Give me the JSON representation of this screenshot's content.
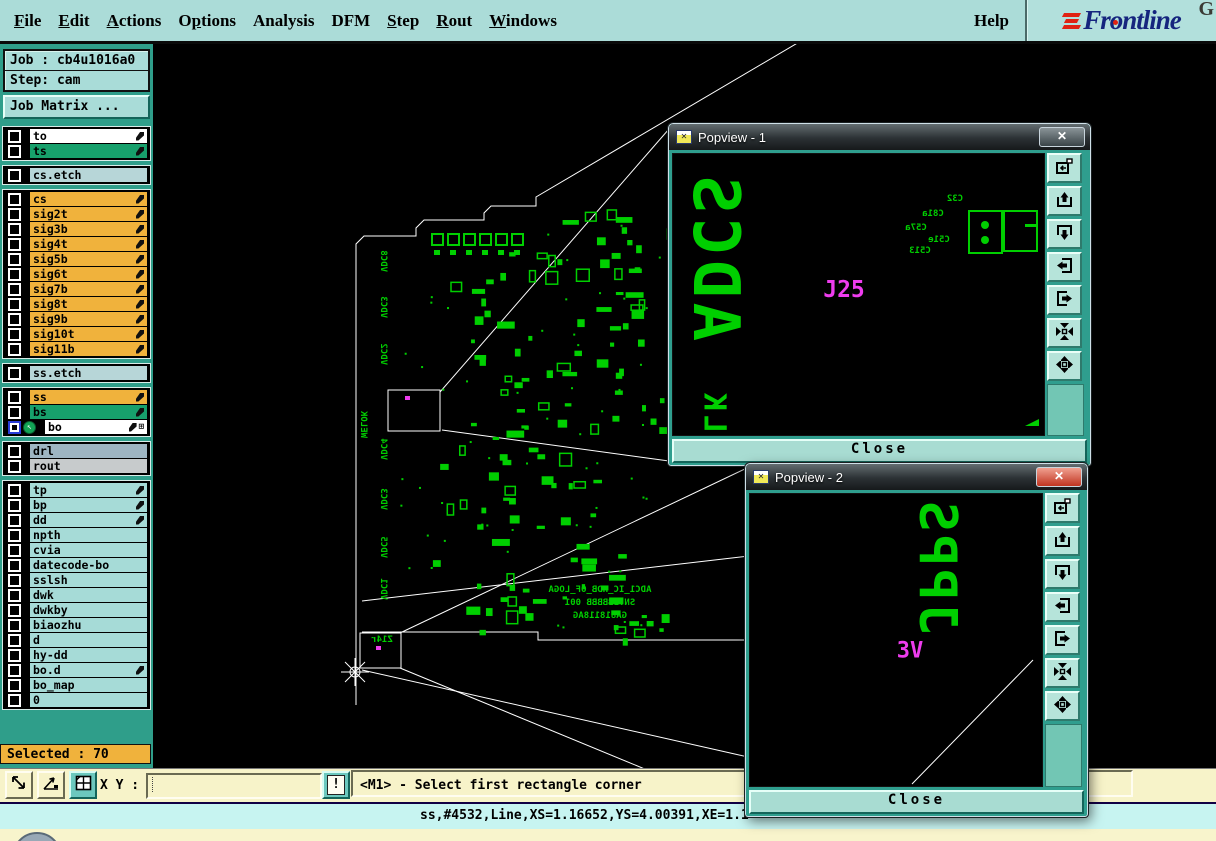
{
  "menubar": {
    "items": [
      {
        "label": "File",
        "u": 0
      },
      {
        "label": "Edit",
        "u": 0
      },
      {
        "label": "Actions",
        "u": 0
      },
      {
        "label": "Options",
        "u": 1
      },
      {
        "label": "Analysis",
        "u": -1
      },
      {
        "label": "DFM",
        "u": -1
      },
      {
        "label": "Step",
        "u": 0
      },
      {
        "label": "Rout",
        "u": 0
      },
      {
        "label": "Windows",
        "u": 0
      }
    ],
    "help": {
      "label": "Help",
      "u": -1
    },
    "logo": {
      "text": "Frontline",
      "corner_letter": "G",
      "navy": "#15257e",
      "red": "#e02212"
    }
  },
  "sidebar": {
    "job_label": "Job : cb4u1016a0",
    "step_label": "Step: cam",
    "job_matrix_button": "Job Matrix ...",
    "selected_label": "Selected : 70",
    "layer_groups": [
      {
        "rows": [
          {
            "label": "to",
            "color": "white",
            "feather": true
          },
          {
            "label": "ts",
            "color": "green",
            "feather": true
          }
        ]
      },
      {
        "rows": [
          {
            "label": "cs.etch",
            "color": "pale"
          }
        ]
      },
      {
        "rows": [
          {
            "label": "cs",
            "color": "orange",
            "feather": true
          },
          {
            "label": "sig2t",
            "color": "orange",
            "feather": true
          },
          {
            "label": "sig3b",
            "color": "orange",
            "feather": true
          },
          {
            "label": "sig4t",
            "color": "orange",
            "feather": true
          },
          {
            "label": "sig5b",
            "color": "orange",
            "feather": true
          },
          {
            "label": "sig6t",
            "color": "orange",
            "feather": true
          },
          {
            "label": "sig7b",
            "color": "orange",
            "feather": true
          },
          {
            "label": "sig8t",
            "color": "orange",
            "feather": true
          },
          {
            "label": "sig9b",
            "color": "orange",
            "feather": true
          },
          {
            "label": "sig10t",
            "color": "orange",
            "feather": true
          },
          {
            "label": "sig11b",
            "color": "orange",
            "feather": true
          }
        ]
      },
      {
        "rows": [
          {
            "label": "ss.etch",
            "color": "pale"
          }
        ]
      },
      {
        "rows": [
          {
            "label": "ss",
            "color": "orange",
            "feather": true
          },
          {
            "label": "bs",
            "color": "green",
            "feather": true
          },
          {
            "label": "bo",
            "color": "white",
            "feather": true,
            "active": true,
            "grid": true
          }
        ]
      },
      {
        "rows": [
          {
            "label": "drl",
            "color": "slate"
          },
          {
            "label": "rout",
            "color": "gray"
          }
        ]
      },
      {
        "rows": [
          {
            "label": "tp",
            "color": "cyan",
            "feather": true
          },
          {
            "label": "bp",
            "color": "cyan",
            "feather": true
          },
          {
            "label": "dd",
            "color": "cyan",
            "feather": true
          },
          {
            "label": "npth",
            "color": "cyan"
          },
          {
            "label": "cvia",
            "color": "cyan"
          },
          {
            "label": "datecode-bo",
            "color": "cyan"
          },
          {
            "label": "sslsh",
            "color": "cyan"
          },
          {
            "label": "dwk",
            "color": "cyan"
          },
          {
            "label": "dwkby",
            "color": "cyan"
          },
          {
            "label": "biaozhu",
            "color": "cyan"
          },
          {
            "label": "d",
            "color": "cyan"
          },
          {
            "label": "hy-dd",
            "color": "cyan"
          },
          {
            "label": "bo.d",
            "color": "cyan",
            "feather": true
          },
          {
            "label": "bo_map",
            "color": "cyan"
          },
          {
            "label": "0",
            "color": "cyan"
          }
        ]
      }
    ]
  },
  "bottom_toolbar": {
    "xy_label": "X Y :",
    "xy_value": "",
    "alert_label": "!",
    "icons": [
      {
        "name": "resize-diagonal-icon"
      },
      {
        "name": "angle-snap-icon"
      },
      {
        "name": "tile-grid-icon"
      }
    ]
  },
  "prompt_bar": {
    "text": "<M1> - Select first rectangle corner"
  },
  "status_bar": {
    "text": "ss,#4532,Line,XS=1.16652,YS=4.00391,XE=1.1"
  },
  "canvas": {
    "left_labels": [
      "VDC8",
      "VDC3",
      "VDC2",
      "VDC4",
      "VDC3",
      "VDC5",
      "VDC1"
    ],
    "left_label_bottom": "WELOK",
    "board_text_lines": [
      "ADC1_IC_HDB_OF_LOGA",
      "SN:BBBBBB 001",
      "GA818118AG"
    ],
    "zoom_rect_label": "Z14r"
  },
  "popviews": [
    {
      "title": "Popview - 1",
      "close_x": "✕",
      "close_label": "Close",
      "big_vertical": "ADCS",
      "ref_label": "J25",
      "corner_label": "LK",
      "small_refs": [
        "C32",
        "C81a",
        "C57a",
        "C51e",
        "C513"
      ],
      "tool_icons": [
        {
          "name": "view-snapshot-icon"
        },
        {
          "name": "pan-up-icon"
        },
        {
          "name": "pan-down-icon"
        },
        {
          "name": "pan-left-icon"
        },
        {
          "name": "pan-right-icon"
        },
        {
          "name": "zoom-out-icon"
        },
        {
          "name": "zoom-in-icon"
        }
      ]
    },
    {
      "title": "Popview - 2",
      "close_x": "✕",
      "close_label": "Close",
      "big_vertical": "JPPS",
      "ref_label": "3V",
      "small_refs": [],
      "tool_icons": [
        {
          "name": "view-snapshot-icon"
        },
        {
          "name": "pan-up-icon"
        },
        {
          "name": "pan-down-icon"
        },
        {
          "name": "pan-left-icon"
        },
        {
          "name": "pan-right-icon"
        },
        {
          "name": "zoom-out-icon"
        },
        {
          "name": "zoom-in-icon"
        }
      ]
    }
  ],
  "colors": {
    "menu_bg": "#abdcd8",
    "sidebar_teal": "#2f9e8a",
    "layer_orange": "#f0b23c",
    "layer_green": "#17a06c",
    "cream": "#f7f3c9",
    "status_cyan": "#c7f4f1",
    "pcb_green": "#00cf00",
    "magenta": "#ee3cee",
    "popup_frame_teal": "#2f9e8e"
  }
}
